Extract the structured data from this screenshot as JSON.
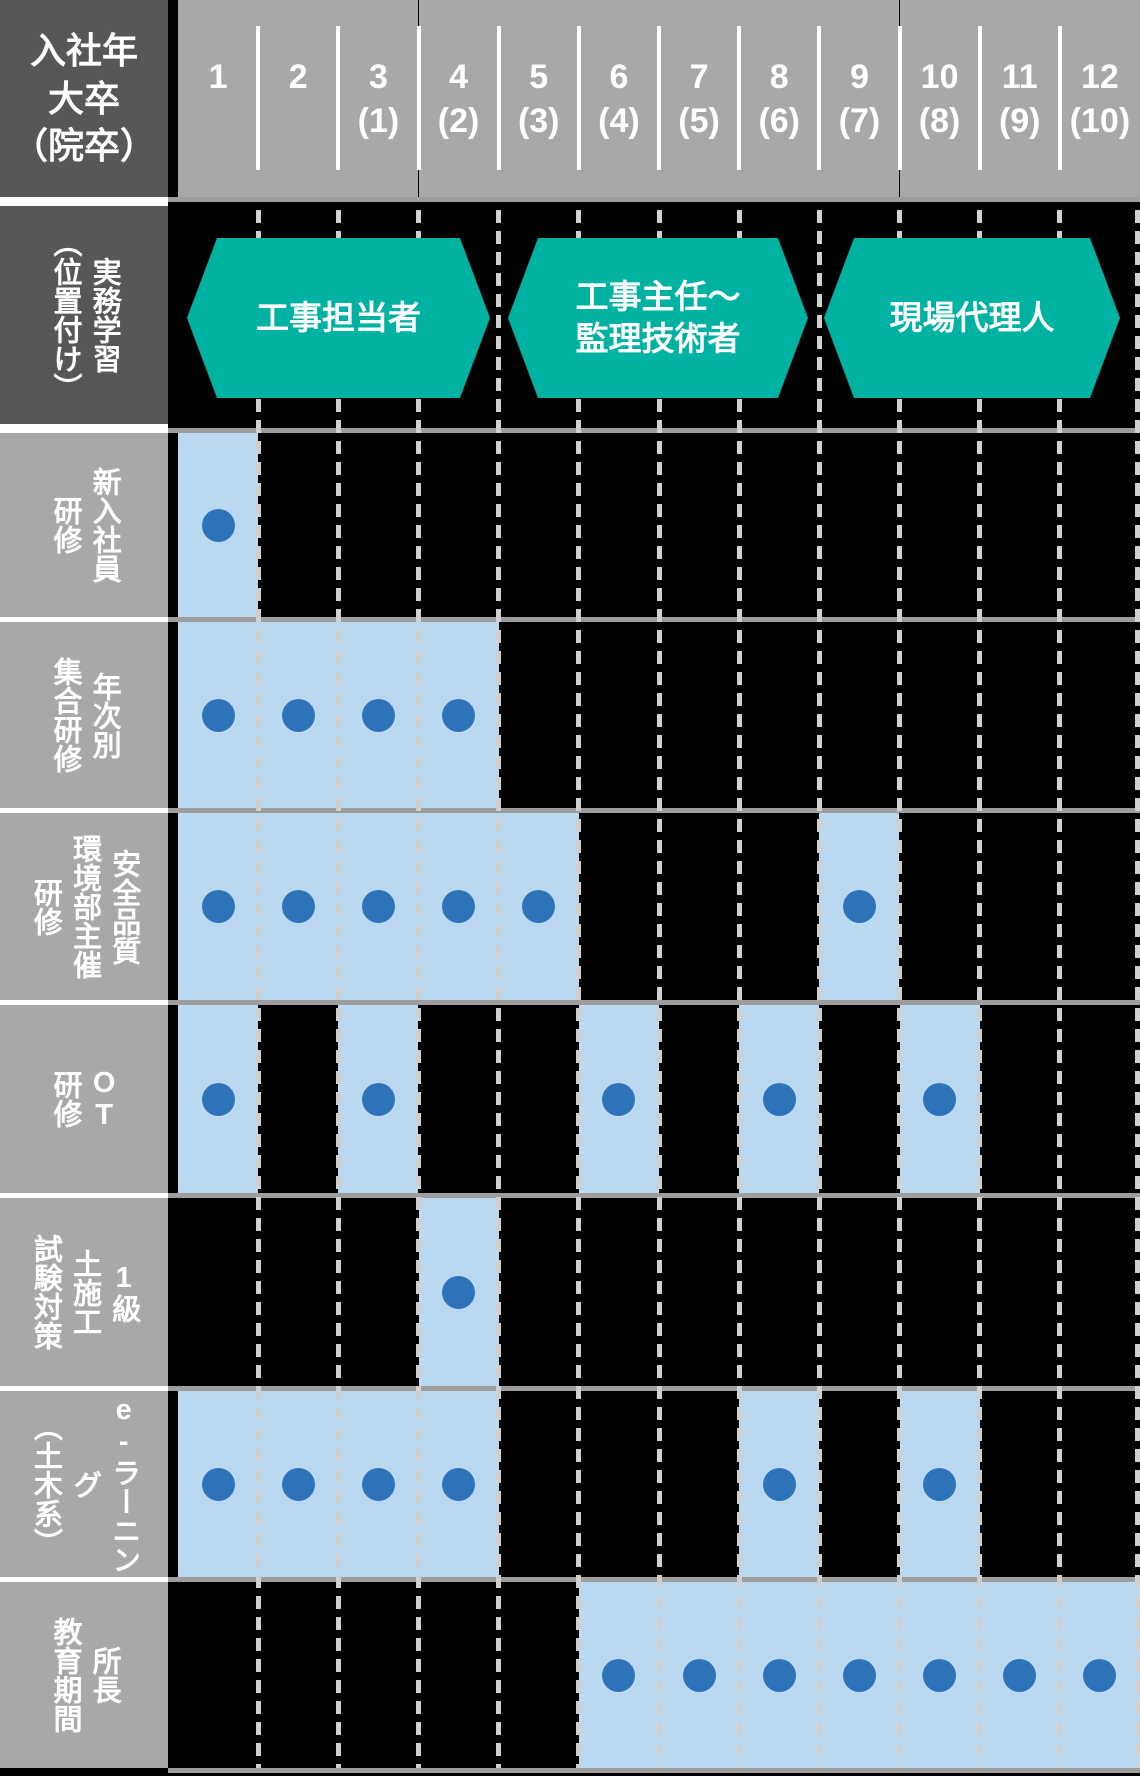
{
  "colors": {
    "teal": "#00b2a2",
    "light_blue": "#bad9f1",
    "dot_blue": "#2e73b8",
    "dark_gray": "#585656",
    "gray": "#a8a8a9",
    "row_line_gray": "#9d9d9d",
    "dash_gray": "#d0d0d0"
  },
  "corner": {
    "lines": [
      "入社年",
      "大卒",
      "（院卒）"
    ]
  },
  "year_columns": [
    {
      "main": "1",
      "sub": ""
    },
    {
      "main": "2",
      "sub": ""
    },
    {
      "main": "3",
      "sub": "(1)"
    },
    {
      "main": "4",
      "sub": "(2)"
    },
    {
      "main": "5",
      "sub": "(3)"
    },
    {
      "main": "6",
      "sub": "(4)"
    },
    {
      "main": "7",
      "sub": "(5)"
    },
    {
      "main": "8",
      "sub": "(6)"
    },
    {
      "main": "9",
      "sub": "(7)"
    },
    {
      "main": "10",
      "sub": "(8)"
    },
    {
      "main": "11",
      "sub": "(9)"
    },
    {
      "main": "12",
      "sub": "(10)"
    }
  ],
  "position_row": {
    "label": [
      "実務学習",
      "（位置付け）"
    ],
    "arrows": [
      {
        "text": [
          "工事担当者"
        ],
        "start_col": 1,
        "end_col": 4
      },
      {
        "text": [
          "工事主任〜",
          "監理技術者"
        ],
        "start_col": 5,
        "end_col": 8
      },
      {
        "text": [
          "現場代理人"
        ],
        "start_col": 9,
        "end_col": 12
      }
    ]
  },
  "training_rows": [
    {
      "label": [
        "新入社員",
        "研修"
      ],
      "bars": [
        [
          1,
          1
        ]
      ],
      "dots": [
        1
      ]
    },
    {
      "label": [
        "年次別",
        "集合研修"
      ],
      "bars": [
        [
          1,
          4
        ]
      ],
      "dots": [
        1,
        2,
        3,
        4
      ]
    },
    {
      "label": [
        "安全品質",
        "環境部主催",
        "研修"
      ],
      "bars": [
        [
          1,
          5
        ],
        [
          9,
          9
        ]
      ],
      "dots": [
        1,
        2,
        3,
        4,
        5,
        9
      ]
    },
    {
      "label": [
        "OT",
        "研修"
      ],
      "bars": [
        [
          1,
          1
        ],
        [
          3,
          3
        ],
        [
          6,
          6
        ],
        [
          8,
          8
        ],
        [
          10,
          10
        ]
      ],
      "dots": [
        1,
        3,
        6,
        8,
        10
      ]
    },
    {
      "label": [
        "1級",
        "土施工",
        "試験対策"
      ],
      "bars": [
        [
          4,
          4
        ]
      ],
      "dots": [
        4
      ]
    },
    {
      "label": [
        "e-ラーニング",
        "（土木系）"
      ],
      "bars": [
        [
          1,
          4
        ],
        [
          8,
          8
        ],
        [
          10,
          10
        ]
      ],
      "dots": [
        1,
        2,
        3,
        4,
        8,
        10
      ]
    },
    {
      "label": [
        "所長",
        "教育期間"
      ],
      "bars": [
        [
          6,
          12
        ]
      ],
      "dots": [
        6,
        7,
        8,
        9,
        10,
        11,
        12
      ]
    }
  ]
}
